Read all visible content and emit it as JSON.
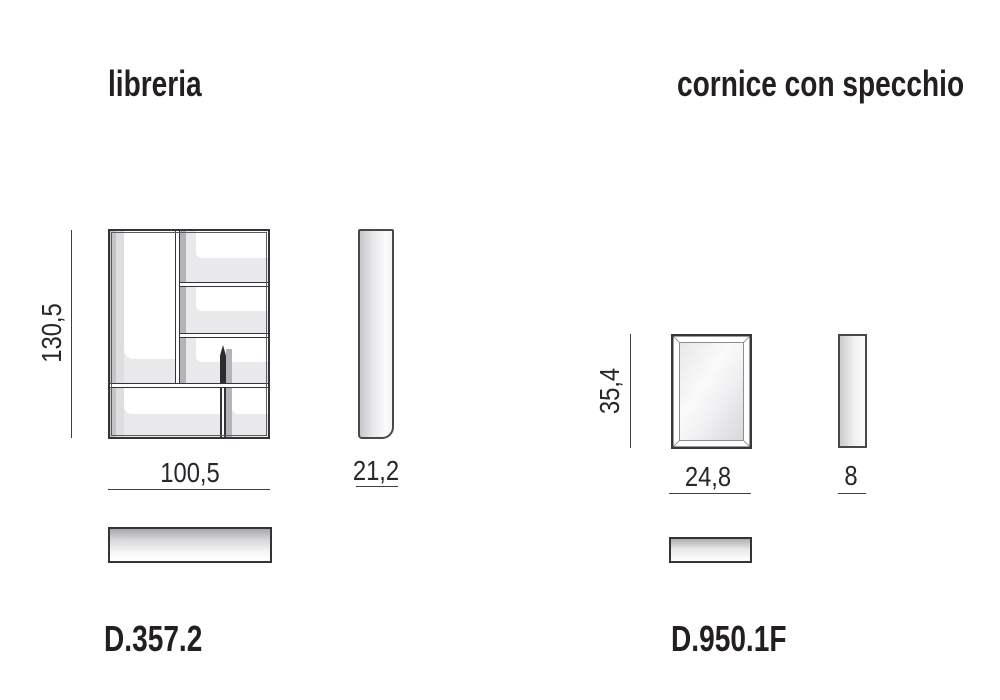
{
  "products": [
    {
      "id": "libreria",
      "title": "libreria",
      "model": "D.357.2",
      "dimensions": {
        "height": "130,5",
        "width": "100,5",
        "depth": "21,2"
      }
    },
    {
      "id": "cornice-con-specchio",
      "title": "cornice con specchio",
      "model": "D.950.1F",
      "dimensions": {
        "height": "35,4",
        "width": "24,8",
        "depth": "8"
      }
    }
  ],
  "colors": {
    "background": "#ffffff",
    "line": "#333338",
    "dimension_line": "#3f3f44",
    "text": "#231f20",
    "dimension_text": "#27272c",
    "shade_light": "#e9e9eb",
    "shade_mid": "#c4c4c8",
    "shade_shadow": "#b4b4b8"
  }
}
